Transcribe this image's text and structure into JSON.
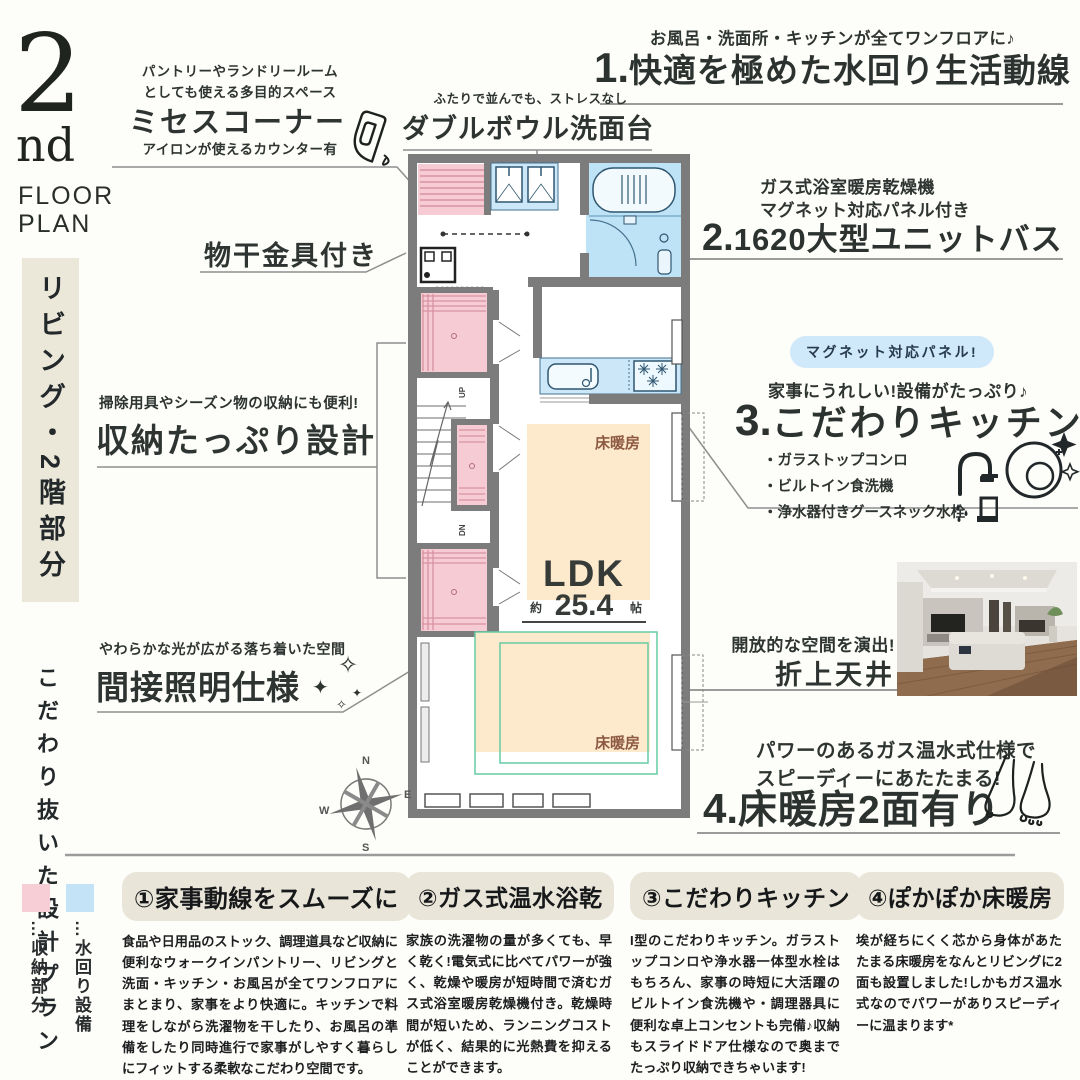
{
  "logo": {
    "number": "2",
    "nd": "nd",
    "floor": "FLOOR",
    "plan": "PLAN"
  },
  "sidebar": {
    "banner": "リビング・2階部分",
    "caption": "こだわり抜いた設計プラン"
  },
  "ann": {
    "mrs": {
      "line1": "パントリーやランドリールーム",
      "line2": "としても使える多目的スペース",
      "title": "ミセスコーナー",
      "note": "アイロンが使えるカウンター有"
    },
    "bowl": {
      "note": "ふたりで並んでも、ストレスなし",
      "title": "ダブルボウル洗面台"
    },
    "laundry": {
      "title": "物干金具付き"
    },
    "storage": {
      "note": "掃除用具やシーズン物の収納にも便利!",
      "title": "収納たっぷり設計"
    },
    "lighting": {
      "note": "やわらかな光が広がる落ち着いた空間",
      "title": "間接照明仕様"
    }
  },
  "features": {
    "f1": {
      "note": "お風呂・洗面所・キッチンが全てワンフロアに♪",
      "num": "1.",
      "title": "快適を極めた水回り生活動線"
    },
    "f2": {
      "note1": "ガス式浴室暖房乾燥機",
      "note2": "マグネット対応パネル付き",
      "num": "2.",
      "title": "1620大型ユニットバス"
    },
    "f3": {
      "badge": "マグネット対応パネル!",
      "note": "家事にうれしい!設備がたっぷり♪",
      "num": "3.",
      "title": "こだわりキッチン",
      "items": [
        "・ガラストップコンロ",
        "・ビルトイン食洗機",
        "・浄水器付きグースネック水栓"
      ]
    },
    "ceiling": {
      "note": "開放的な空間を演出!",
      "title": "折上天井"
    },
    "f4": {
      "note1": "パワーのあるガス温水式仕様で",
      "note2": "スピーディーにあたたまる!",
      "num": "4.",
      "title": "床暖房2面有り"
    }
  },
  "plan": {
    "floor_heating": "床暖房",
    "ldk": "LDK",
    "approx": "約",
    "area": "25.4",
    "unit": "帖",
    "up": "UP",
    "dn": "DN",
    "compass": {
      "n": "N",
      "e": "E",
      "s": "S",
      "w": "W"
    }
  },
  "legend": {
    "storage": {
      "label": "…収納部分",
      "color": "#f8ced6"
    },
    "water": {
      "label": "…水回り設備",
      "color": "#c5e3f6"
    }
  },
  "columns": [
    {
      "title": "①家事動線をスムーズに",
      "body": "食品や日用品のストック、調理道具など収納に便利なウォークインパントリー、リビングと洗面・キッチン・お風呂が全てワンフロアにまとまり、家事をより快適に。キッチンで料理をしながら洗濯物を干したり、お風呂の準備をしたり同時進行で家事がしやすく暮らしにフィットする柔軟なこだわり空間です。"
    },
    {
      "title": "②ガス式温水浴乾",
      "body": "家族の洗濯物の量が多くても、早く乾く!電気式に比べてパワーが強く、乾燥や暖房が短時間で済むガス式浴室暖房乾燥機付き。乾燥時間が短いため、ランニングコストが低く、結果的に光熱費を抑えることができます。"
    },
    {
      "title": "③こだわりキッチン",
      "body": "I型のこだわりキッチン。ガラストップコンロや浄水器一体型水栓はもちろん、家事の時短に大活躍のビルトイン食洗機や・調理器具に便利な卓上コンセントも完備♪収納もスライドドア仕様なので奥までたっぷり収納できちゃいます!"
    },
    {
      "title": "④ぽかぽか床暖房",
      "body": "埃が経ちにくく芯から身体があたたまる床暖房をなんとリビングに2面も設置しました!しかもガス温水式なのでパワーがありスピーディーに温まります*"
    }
  ],
  "colors": {
    "storage_pink": "#f8ced6",
    "water_blue": "#c5e3f6",
    "wall_gray": "#7c7c7c",
    "heating_beige": "#fdeacd",
    "heating_green": "#66cba4",
    "badge_blue": "#cfe8fa",
    "label_brown": "#8d5a41",
    "text_dark": "#2e3431",
    "banner_beige": "#ebe8da"
  }
}
